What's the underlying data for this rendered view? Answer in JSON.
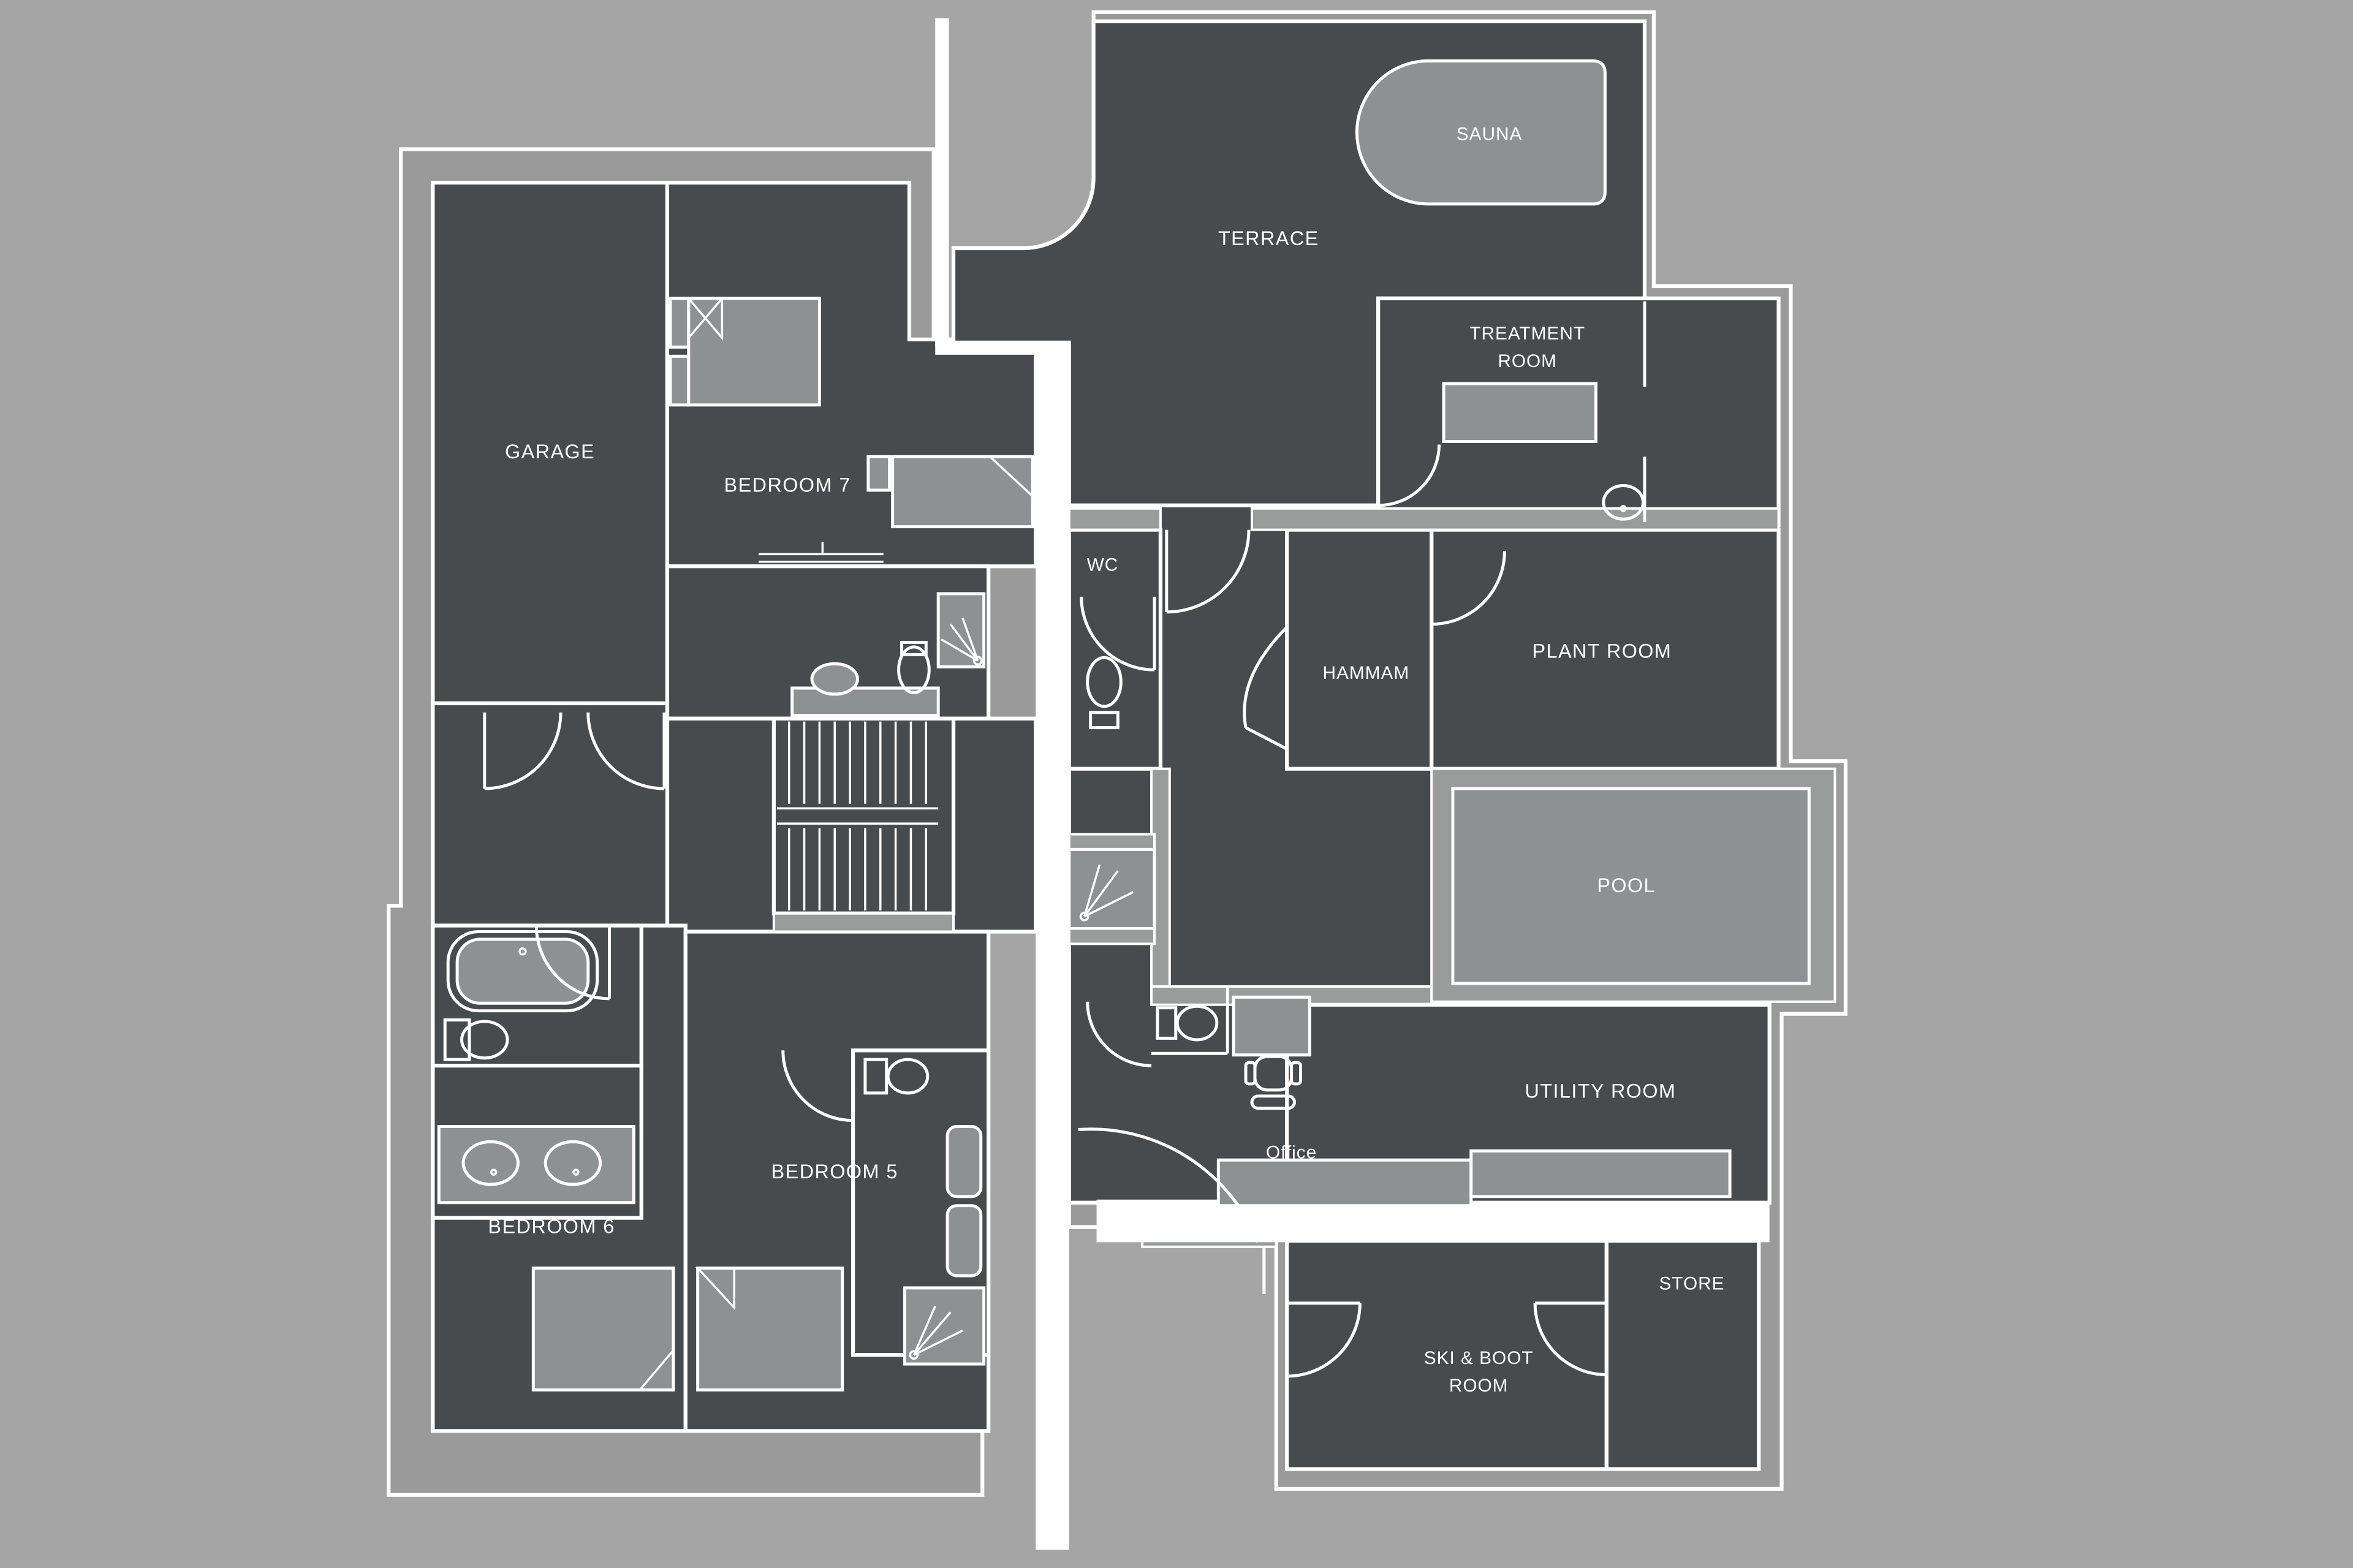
{
  "palette": {
    "background": "#a5a5a5",
    "building_band": "#9a9a9a",
    "room_fill": "#474b4d",
    "wall": "#ffffff",
    "fixture_fill": "#8e9192",
    "pool_fill": "#8e9192",
    "label_color": "#ffffff"
  },
  "rooms": [
    {
      "id": "garage",
      "label": "GARAGE"
    },
    {
      "id": "bedroom7",
      "label": "BEDROOM 7"
    },
    {
      "id": "wc",
      "label": "WC"
    },
    {
      "id": "hammam",
      "label": "HAMMAM"
    },
    {
      "id": "terrace",
      "label": "TERRACE"
    },
    {
      "id": "sauna",
      "label": "SAUNA"
    },
    {
      "id": "treatment-room",
      "label_line1": "TREATMENT",
      "label_line2": "ROOM"
    },
    {
      "id": "plant-room",
      "label": "PLANT ROOM"
    },
    {
      "id": "pool",
      "label": "POOL"
    },
    {
      "id": "utility-room",
      "label": "UTILITY ROOM"
    },
    {
      "id": "office",
      "label": "Office"
    },
    {
      "id": "bedroom5",
      "label": "BEDROOM 5"
    },
    {
      "id": "bedroom6",
      "label": "BEDROOM 6"
    },
    {
      "id": "store",
      "label": "STORE"
    },
    {
      "id": "ski-boot-room",
      "label_line1": "SKI & BOOT",
      "label_line2": "ROOM"
    }
  ],
  "fixtures": [
    "sauna-bench",
    "massage-table",
    "toilet",
    "basin",
    "double-bed",
    "single-bed",
    "bath-tub",
    "shower",
    "stairs",
    "pool",
    "office-desk",
    "office-chair",
    "vanity-two-sinks",
    "utility-counter",
    "towel-radiator",
    "door-swing"
  ]
}
